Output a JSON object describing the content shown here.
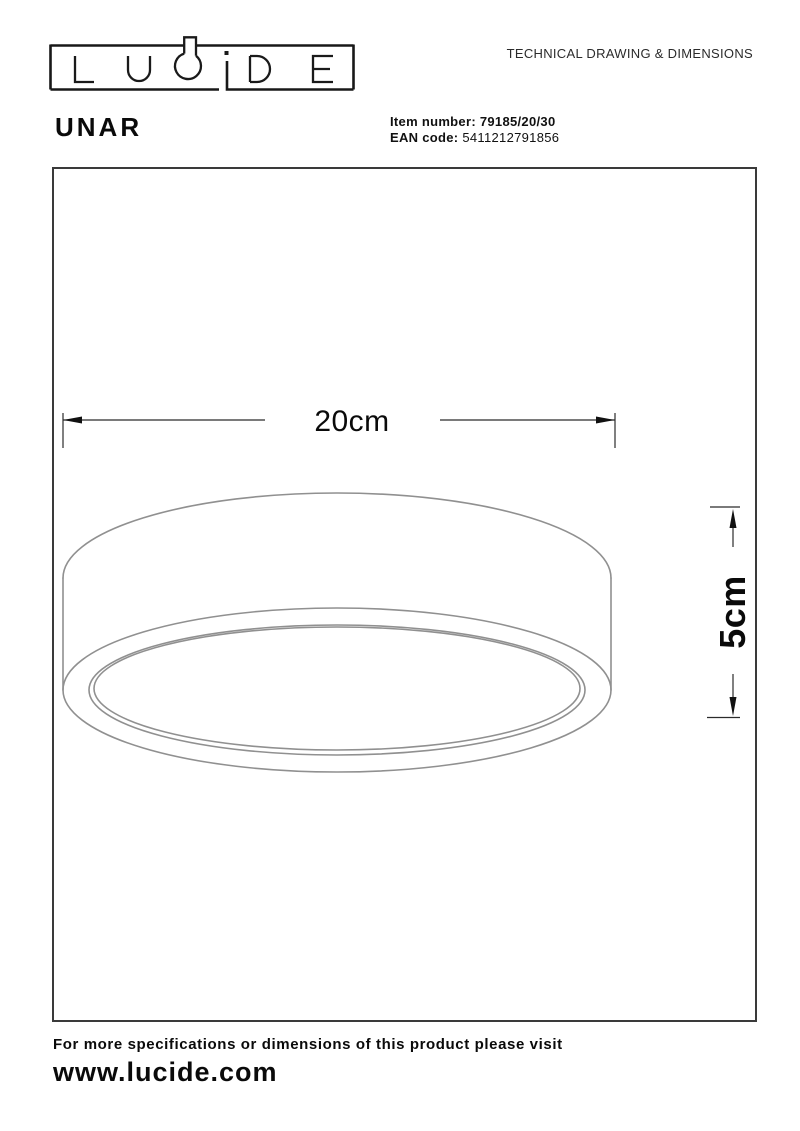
{
  "header": {
    "brand": "LUCIDE",
    "title": "TECHNICAL DRAWING & DIMENSIONS"
  },
  "product": {
    "name": "UNAR",
    "item_label": "Item number:",
    "item_value": "79185/20/30",
    "ean_label": "EAN code:",
    "ean_value": "5411212791856"
  },
  "drawing": {
    "width_label": "20cm",
    "height_label": "5cm"
  },
  "footer": {
    "note": "For more specifications or dimensions of this product please visit",
    "website": "www.lucide.com"
  },
  "colors": {
    "lamp_line": "#909090",
    "dimension_line": "#2b2b2b",
    "box_border": "#3a3a3a",
    "text": "#0a0a0a"
  }
}
